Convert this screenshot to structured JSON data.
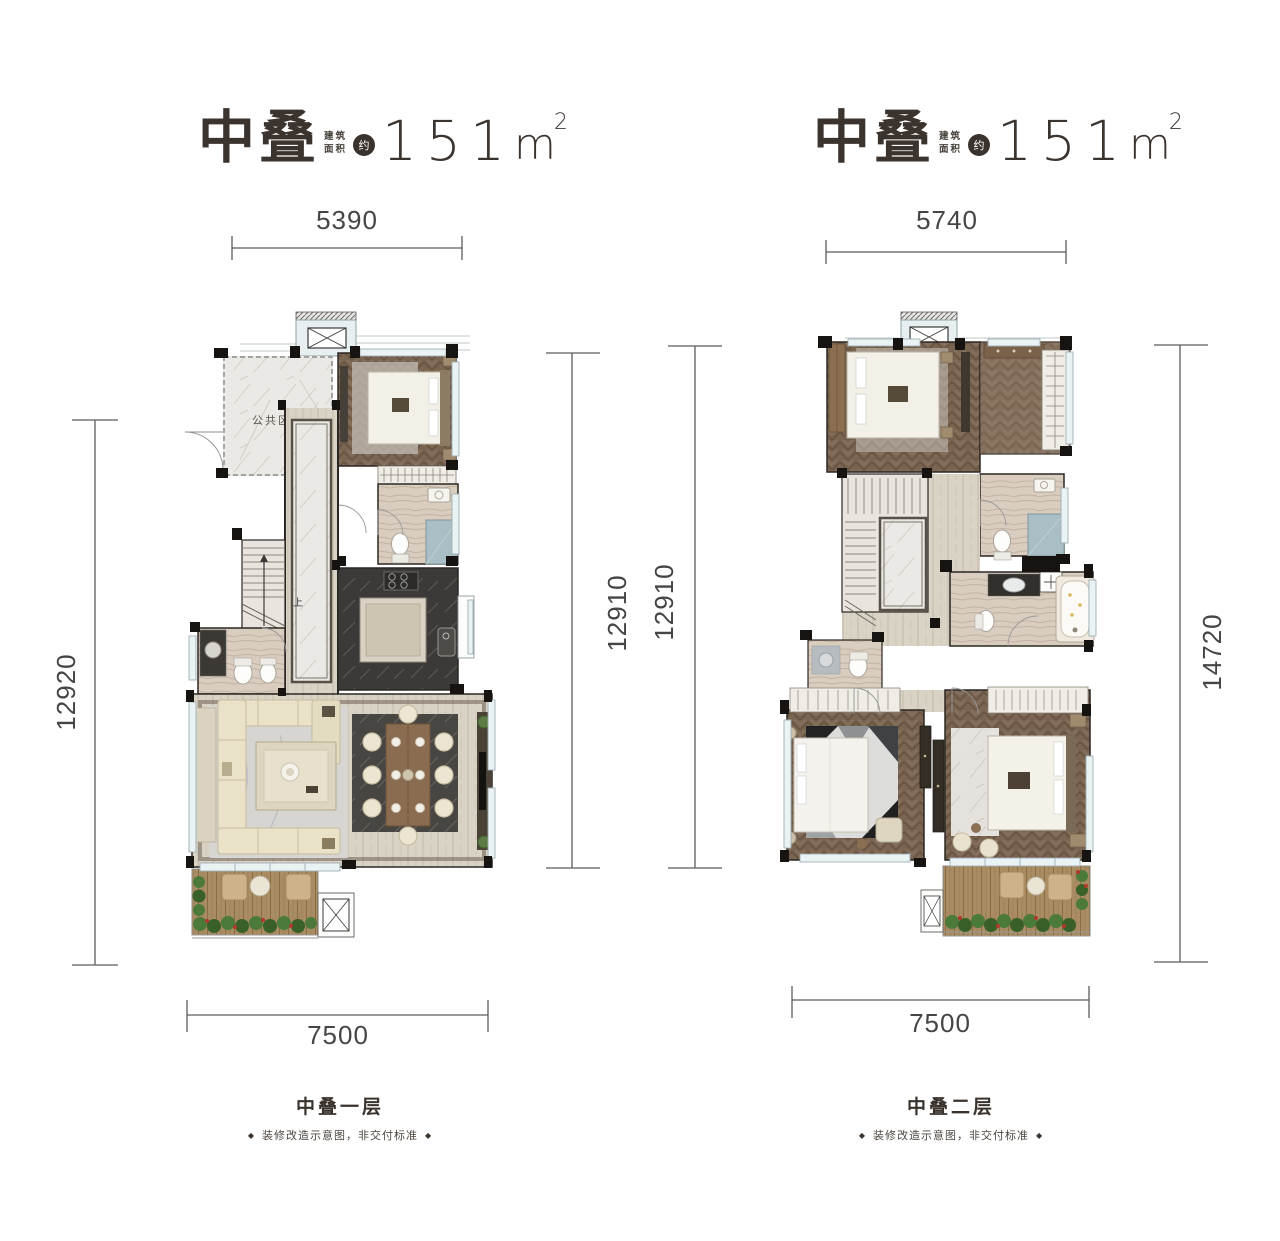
{
  "left_plan": {
    "title": {
      "name": "中叠",
      "area_label_row1": "建筑",
      "area_label_row2": "面积",
      "approx": "约",
      "area_value": "151",
      "unit_base": "m",
      "unit_exp": "2"
    },
    "dims": {
      "top": "5390",
      "left": "12920",
      "right": "12910",
      "bottom": "7500"
    },
    "rooms": {
      "public_area": "公共区域",
      "stairs_up": "上"
    },
    "footer": {
      "floor": "中叠一层",
      "disclaimer": "装修改造示意图，非交付标准",
      "diamond": "◆"
    }
  },
  "right_plan": {
    "title": {
      "name": "中叠",
      "area_label_row1": "建筑",
      "area_label_row2": "面积",
      "approx": "约",
      "area_value": "151",
      "unit_base": "m",
      "unit_exp": "2"
    },
    "dims": {
      "left": "12910",
      "top": "5740",
      "right": "14720",
      "bottom": "7500"
    },
    "footer": {
      "floor": "中叠二层",
      "disclaimer": "装修改造示意图，非交付标准",
      "diamond": "◆"
    }
  },
  "colors": {
    "accent_dark": "#3a322c",
    "wall": "#161310",
    "dim_line": "#5b5c5e",
    "window": "#eaf3f4",
    "wood": "#7a6553",
    "deck": "#a98c63"
  }
}
